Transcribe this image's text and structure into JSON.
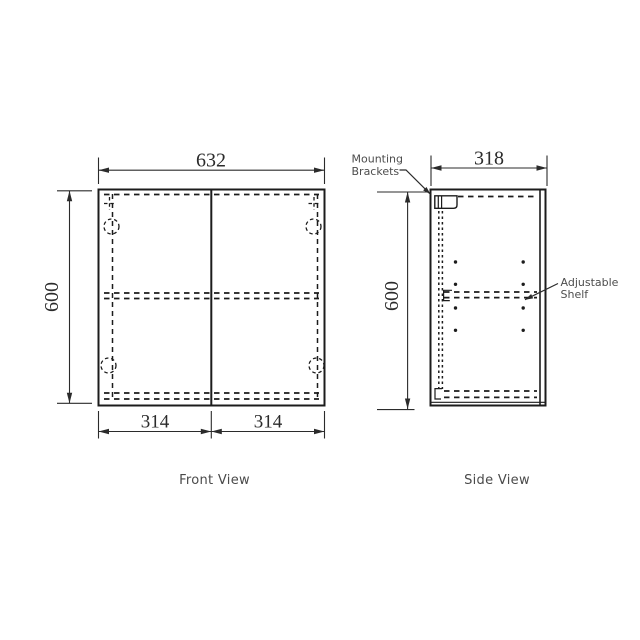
{
  "colors": {
    "background": "#ffffff",
    "line": "#1c1c1c",
    "dimension_text": "#2b2b2b",
    "label_text": "#4d4d4d"
  },
  "front_view": {
    "caption": "Front View",
    "dims": {
      "width": "632",
      "height": "600",
      "door_left": "314",
      "door_right": "314"
    }
  },
  "side_view": {
    "caption": "Side View",
    "dims": {
      "depth": "318",
      "height": "600"
    }
  },
  "annotations": {
    "mounting_brackets": {
      "line1": "Mounting",
      "line2": "Brackets"
    },
    "adjustable_shelf": {
      "line1": "Adjustable",
      "line2": "Shelf"
    }
  }
}
